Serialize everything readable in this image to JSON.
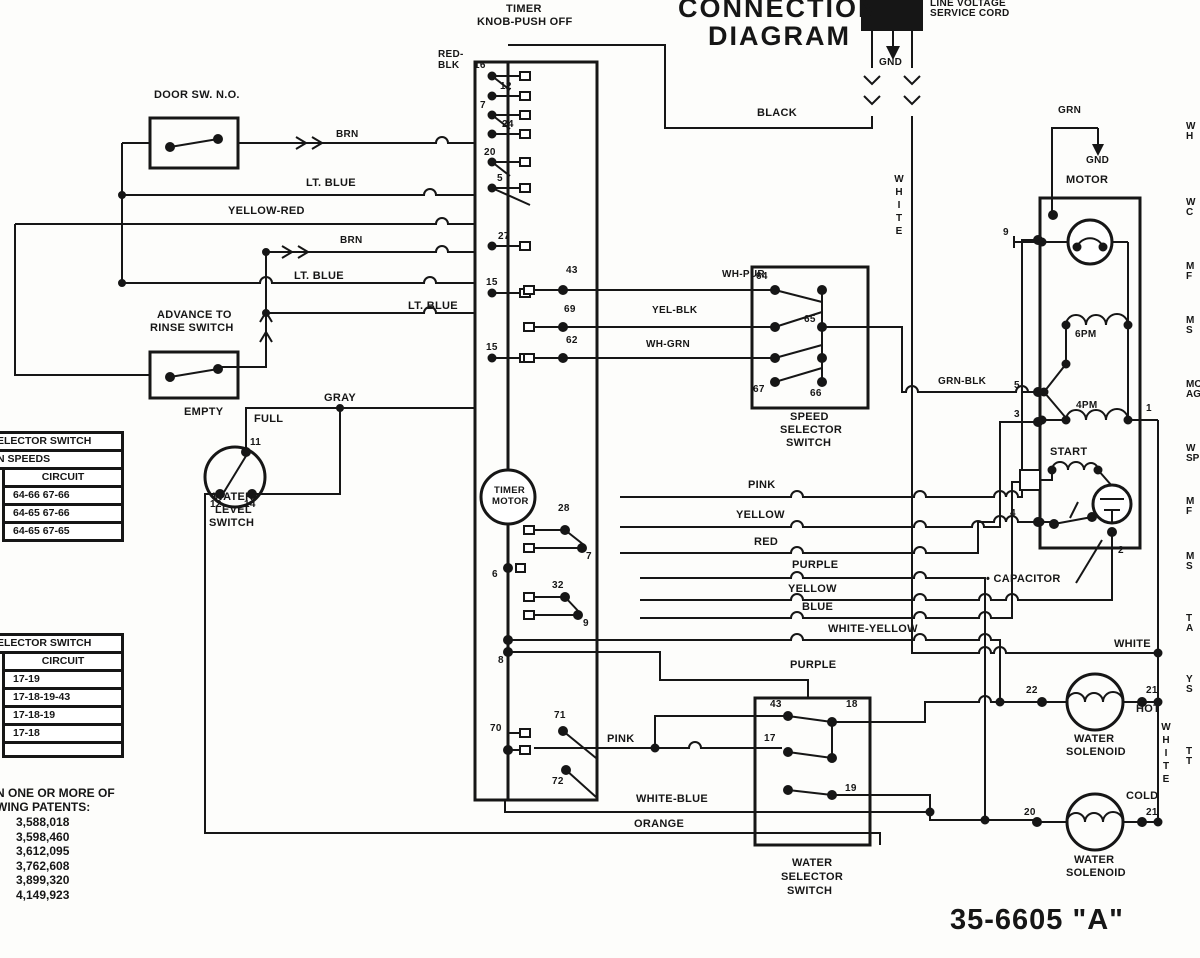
{
  "header": {
    "title1": "CONNECTION",
    "title2": "DIAGRAM",
    "line_voltage1": "LINE VOLTAGE",
    "line_voltage2": "SERVICE CORD",
    "model": "35-6605 \"A\""
  },
  "labels": {
    "gnd1": "GND",
    "black": "BLACK",
    "white_v1": "WHITE",
    "white_v2": "WHITE",
    "white_h": "WHITE",
    "timer1": "TIMER",
    "timer2": "KNOB-PUSH OFF",
    "redblk1": "RED-",
    "redblk2": "BLK",
    "door": "DOOR SW. N.O.",
    "brn1": "BRN",
    "ltblue1": "LT. BLUE",
    "yelred": "YELLOW-RED",
    "brn2": "BRN",
    "ltblue2": "LT. BLUE",
    "ltblue3": "LT. BLUE",
    "adv1": "ADVANCE TO",
    "adv2": "RINSE SWITCH",
    "gray": "GRAY",
    "empty": "EMPTY",
    "full": "FULL",
    "wl1": "WATER",
    "wl2": "LEVEL",
    "wl3": "SWITCH",
    "wl11": "11",
    "wl12": "12",
    "wl14": "14",
    "t16": "16",
    "t12": "12",
    "t7": "7",
    "t24": "24",
    "t20": "20",
    "t5": "5",
    "t27": "27",
    "t15a": "15",
    "t15b": "15",
    "t43": "43",
    "t69": "69",
    "t62": "62",
    "t28": "28",
    "tc7": "7",
    "t32": "32",
    "tc9": "9",
    "t6": "6",
    "t8": "8",
    "t70": "70",
    "t71": "71",
    "t72": "72",
    "tmotor1": "TIMER",
    "tmotor2": "MOTOR",
    "whpur": "WH-PUR",
    "yelblk": "YEL-BLK",
    "whgrn": "WH-GRN",
    "s64": "64",
    "s65": "65",
    "s67": "67",
    "s66": "66",
    "spd1": "SPEED",
    "spd2": "SELECTOR",
    "spd3": "SWITCH",
    "grnblk": "GRN-BLK",
    "grn": "GRN",
    "gnd2": "GND",
    "motor": "MOTOR",
    "m9": "9",
    "pm6": "6PM",
    "m5": "5",
    "pm4": "4PM",
    "m3": "3",
    "m1": "1",
    "start": "START",
    "m4": "4",
    "m2": "2",
    "capacitor": "• CAPACITOR",
    "pink1": "PINK",
    "yellow1": "YELLOW",
    "red": "RED",
    "purple1": "PURPLE",
    "yellow2": "YELLOW",
    "blue": "BLUE",
    "whyel": "WHITE-YELLOW",
    "purple2": "PURPLE",
    "pink2": "PINK",
    "whblue": "WHITE-BLUE",
    "orange": "ORANGE",
    "ws43": "43",
    "ws18": "18",
    "ws17": "17",
    "ws19": "19",
    "wsel1": "WATER",
    "wsel2": "SELECTOR",
    "wsel3": "SWITCH",
    "sol22": "22",
    "sol21a": "21",
    "hot": "HOT",
    "sola1": "WATER",
    "sola2": "SOLENOID",
    "cold": "COLD",
    "sol20": "20",
    "sol21b": "21",
    "solb1": "WATER",
    "solb2": "SOLENOID"
  },
  "tables": {
    "speed": {
      "title": "ELECTOR SWITCH",
      "sub": "N SPEEDS",
      "circuit": "CIRCUIT",
      "rows": [
        "64-66 67-66",
        "64-65 67-66",
        "64-65 67-65"
      ]
    },
    "water": {
      "title": "ELECTOR SWITCH",
      "circuit": "CIRCUIT",
      "rows": [
        "17-19",
        "17-18-19-43",
        "17-18-19",
        "17-18",
        ""
      ]
    }
  },
  "patents": {
    "line1": "N ONE OR MORE OF",
    "line2": "WING PATENTS:",
    "numbers": [
      "3,588,018",
      "3,598,460",
      "3,612,095",
      "3,762,608",
      "3,899,320",
      "4,149,923"
    ]
  },
  "edge": [
    {
      "l1": "W",
      "l2": "H"
    },
    {
      "l1": "W",
      "l2": "C"
    },
    {
      "l1": "M",
      "l2": "F"
    },
    {
      "l1": "M",
      "l2": "S"
    },
    {
      "l1": "MO",
      "l2": "AG"
    },
    {
      "l1": "W",
      "l2": "SP"
    },
    {
      "l1": "M",
      "l2": "F"
    },
    {
      "l1": "M",
      "l2": "S"
    },
    {
      "l1": "T",
      "l2": "A"
    },
    {
      "l1": "Y",
      "l2": "S"
    },
    {
      "l1": "T",
      "l2": "T"
    }
  ]
}
